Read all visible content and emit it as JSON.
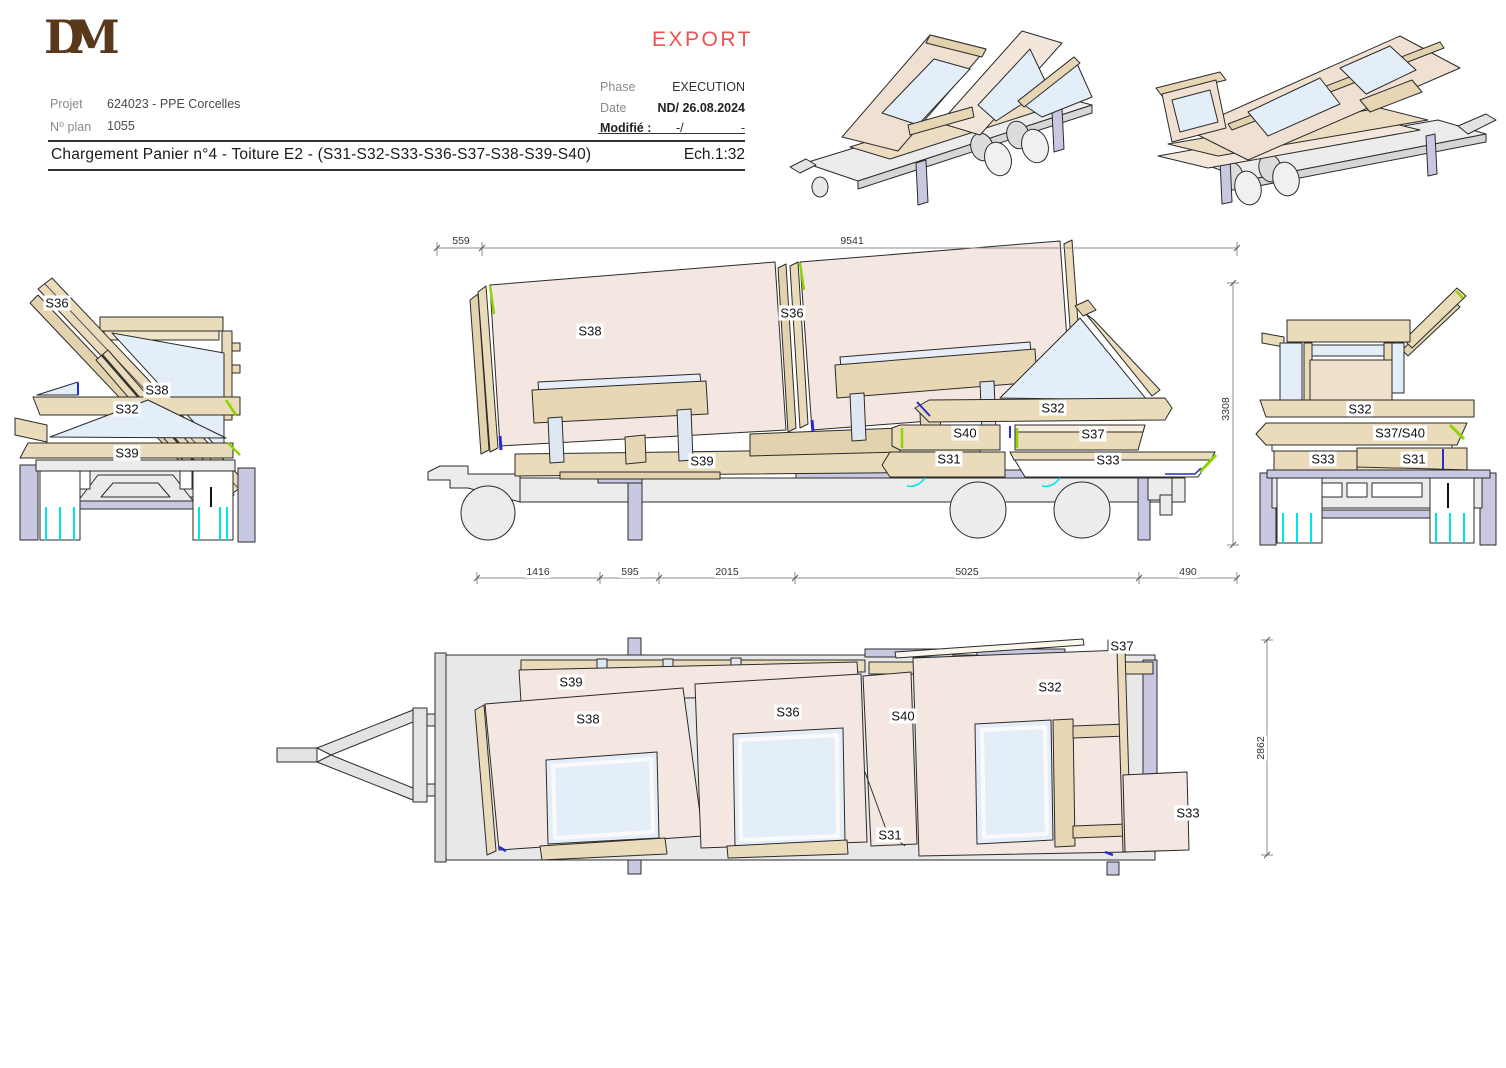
{
  "titleblock": {
    "logo_monogram": "DM",
    "export_stamp": "EXPORT",
    "project_label": "Projet",
    "project_value": "624023 - PPE Corcelles",
    "plan_no_label": "N⁰ plan",
    "plan_no_value": "1055",
    "phase_label": "Phase",
    "phase_value": "EXECUTION",
    "date_label": "Date",
    "date_value": "ND/ 26.08.2024",
    "modified_label": "Modifié :",
    "modified_slash": "-/",
    "modified_dash": "-",
    "title": "Chargement Panier n°4 - Toiture E2 - (S31-S32-S33-S36-S37-S38-S39-S40)",
    "scale": "Ech.1:32"
  },
  "dimensions": {
    "top_left": "559",
    "top_total": "9541",
    "bottom_1": "1416",
    "bottom_2": "595",
    "bottom_3": "2015",
    "bottom_4": "5025",
    "bottom_5": "490",
    "side_height": "3308",
    "plan_width": "2862"
  },
  "labels": {
    "front_view": {
      "s36": "S36",
      "s38": "S38",
      "s32": "S32",
      "s39": "S39"
    },
    "side_view": {
      "s38": "S38",
      "s36": "S36",
      "s32": "S32",
      "s40": "S40",
      "s37": "S37",
      "s31": "S31",
      "s33": "S33",
      "s39": "S39"
    },
    "rear_view": {
      "s32": "S32",
      "s37_s40": "S37/S40",
      "s33": "S33",
      "s31": "S31"
    },
    "plan_view": {
      "s39": "S39",
      "s38": "S38",
      "s36": "S36",
      "s40": "S40",
      "s31": "S31",
      "s32": "S32",
      "s37": "S37",
      "s33": "S33"
    }
  },
  "colors": {
    "export_red": "#f0504e",
    "logo_brown": "#5a381c",
    "panel_pink": "#f4e7e1",
    "wood_tan": "#eadbba",
    "glass_blue": "#e4eef9",
    "trailer_gray": "#ebebeb",
    "lavender": "#c8c8e2",
    "cyan": "#00e6e6",
    "accent_green": "#8fd400",
    "accent_blue": "#2a2ad0"
  }
}
